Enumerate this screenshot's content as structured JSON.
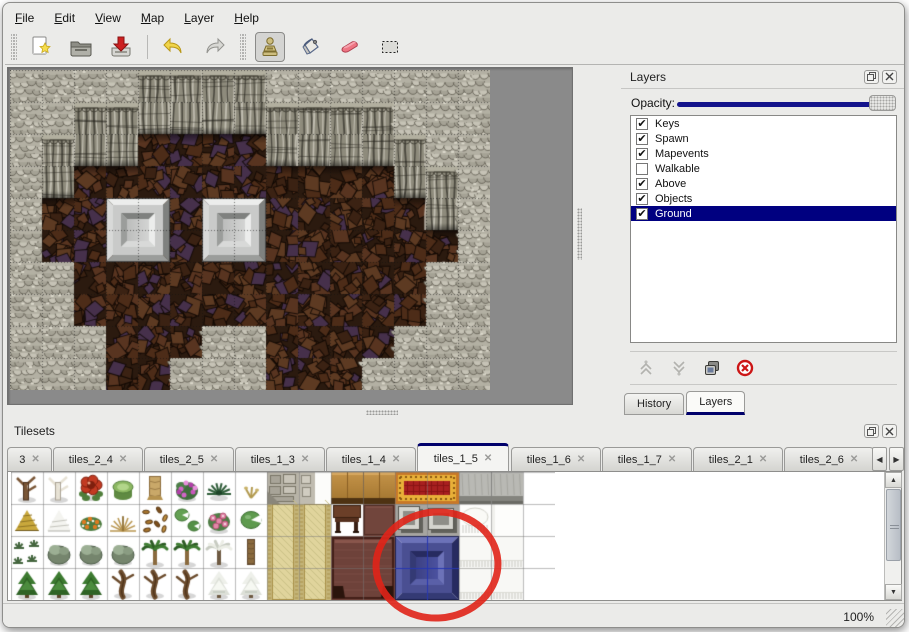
{
  "menu": {
    "items": [
      {
        "mnemonic": "F",
        "rest": "ile"
      },
      {
        "mnemonic": "E",
        "rest": "dit"
      },
      {
        "mnemonic": "V",
        "rest": "iew"
      },
      {
        "mnemonic": "M",
        "rest": "ap"
      },
      {
        "mnemonic": "L",
        "rest": "ayer"
      },
      {
        "mnemonic": "H",
        "rest": "elp"
      }
    ]
  },
  "toolbar": {
    "tools": [
      "new-file",
      "open-file",
      "save-file",
      "undo",
      "redo",
      "stamp",
      "fill",
      "eraser",
      "select"
    ],
    "active_tool": "stamp"
  },
  "map_view": {
    "tile_size": 32,
    "grid_rows": [
      "LLLLCCCCLLLLLLL",
      "LLCCCCCCCCCCLLL",
      "LCCCBBBBCCCCCLL",
      "LCBBBBBBBBBBCCL",
      "LBBBBBBBBBBBBCL",
      "LBBBBBBBBBBBBBL",
      "LLBBBBBBBBBBBLL",
      "LLBBBBBBBBBBBLL",
      "LLLBBBLLBBBBLLL",
      "LLLBBLLLBBBLLLL"
    ],
    "pedestals": [
      [
        3,
        4
      ],
      [
        6,
        4
      ]
    ]
  },
  "layers_panel": {
    "title": "Layers",
    "opacity_label": "Opacity:",
    "opacity_percent": 100,
    "layers": [
      {
        "name": "Keys",
        "checked": true,
        "selected": false
      },
      {
        "name": "Spawn",
        "checked": true,
        "selected": false
      },
      {
        "name": "Mapevents",
        "checked": true,
        "selected": false
      },
      {
        "name": "Walkable",
        "checked": false,
        "selected": false
      },
      {
        "name": "Above",
        "checked": true,
        "selected": false
      },
      {
        "name": "Objects",
        "checked": true,
        "selected": false
      },
      {
        "name": "Ground",
        "checked": true,
        "selected": true
      }
    ],
    "tabs": [
      {
        "label": "History",
        "active": false
      },
      {
        "label": "Layers",
        "active": true
      }
    ]
  },
  "tilesets_panel": {
    "title": "Tilesets",
    "tabs": [
      {
        "label": "3",
        "active": false
      },
      {
        "label": "tiles_2_4",
        "active": false
      },
      {
        "label": "tiles_2_5",
        "active": false
      },
      {
        "label": "tiles_1_3",
        "active": false
      },
      {
        "label": "tiles_1_4",
        "active": false
      },
      {
        "label": "tiles_1_5",
        "active": true
      },
      {
        "label": "tiles_1_6",
        "active": false
      },
      {
        "label": "tiles_1_7",
        "active": false
      },
      {
        "label": "tiles_2_1",
        "active": false
      },
      {
        "label": "tiles_2_6",
        "active": false
      }
    ],
    "veg_rows": [
      [
        "deadtree",
        "whitetree",
        "redflower",
        "stump",
        "trunk",
        "pinkbush",
        "fern",
        "sprout"
      ],
      [
        "hay",
        "snowmound",
        "orangeflowers",
        "drygrass",
        "leaves",
        "lilypads",
        "roses",
        "lilypad"
      ],
      [
        "shrubs",
        "bush",
        "bush",
        "bush",
        "palm",
        "palm",
        "snowtree",
        "palmtrunk"
      ],
      [
        "conifer",
        "conifer",
        "conifer",
        "gnarl",
        "gnarl",
        "gnarl",
        "snowpine",
        "snowpine"
      ]
    ],
    "blocks": [
      {
        "c": 8,
        "r": 0,
        "w": 1,
        "h": 1,
        "t": "cobble"
      },
      {
        "c": 9,
        "r": 0,
        "w": 1,
        "h": 1,
        "t": "cobble2"
      },
      {
        "c": 8,
        "r": 1,
        "w": 1,
        "h": 3,
        "t": "tanCarpet"
      },
      {
        "c": 9,
        "r": 1,
        "w": 1,
        "h": 3,
        "t": "tanCarpet"
      },
      {
        "c": 10,
        "r": 0,
        "w": 2,
        "h": 1,
        "t": "woodTop"
      },
      {
        "c": 10,
        "r": 1,
        "w": 1,
        "h": 1,
        "t": "tableSmall"
      },
      {
        "c": 11,
        "r": 1,
        "w": 1,
        "h": 1,
        "t": "maroon"
      },
      {
        "c": 10,
        "r": 2,
        "w": 2,
        "h": 2,
        "t": "maroonTable"
      },
      {
        "c": 12,
        "r": 0,
        "w": 2,
        "h": 1,
        "t": "redCarpet"
      },
      {
        "c": 12,
        "r": 1,
        "w": 2,
        "h": 1,
        "t": "pillars"
      },
      {
        "c": 14,
        "r": 0,
        "w": 2,
        "h": 1,
        "t": "graySlab"
      },
      {
        "c": 14,
        "r": 1,
        "w": 1,
        "h": 1,
        "t": "snowTuft"
      },
      {
        "c": 15,
        "r": 1,
        "w": 1,
        "h": 1,
        "t": "whiteTile"
      },
      {
        "c": 14,
        "r": 2,
        "w": 2,
        "h": 2,
        "t": "snowBlock"
      },
      {
        "c": 12,
        "r": 2,
        "w": 2,
        "h": 2,
        "t": "blueTile"
      }
    ],
    "selected_tile": {
      "c": 12,
      "r": 2,
      "w": 2,
      "h": 2
    }
  },
  "icons": {
    "close": "✕",
    "check": "✔",
    "arrow_left": "◀",
    "arrow_right": "▶",
    "arrow_up": "▲",
    "arrow_down": "▼"
  },
  "statusbar": {
    "zoom": "100%"
  },
  "annotation": {
    "type": "red-circle",
    "cx": 437,
    "cy": 565,
    "rx": 61,
    "ry": 53,
    "color": "#e02418"
  },
  "colors": {
    "selection_navy": "#000080",
    "accent_navy": "#00006b",
    "slider_blue": "#14148c",
    "annotation_red": "#e02418"
  }
}
